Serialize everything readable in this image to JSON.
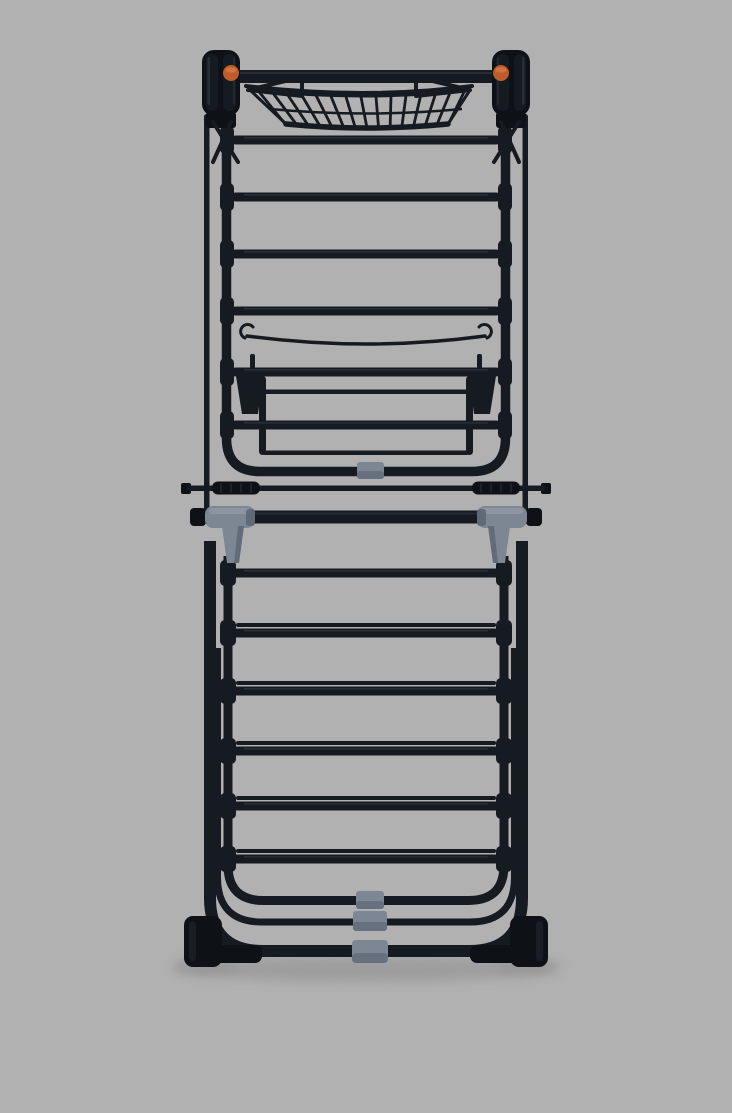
{
  "scene": {
    "type": "product-photo",
    "description": "Black foldable clothes airer drying rack shown folded flat, front view, standing on a plain gray studio background",
    "background": "#b1b1b1"
  },
  "colors": {
    "bg": "#b1b1b1",
    "frame": "#161a21",
    "frame_dark": "#0e1116",
    "highlight": "#3c434e",
    "clip": "#7d8693",
    "clip_dark": "#596270",
    "clip_light": "#9aa3af",
    "accent": "#bf5c2b",
    "accent_light": "#d97f4a",
    "shadow": "#8f8f8f"
  },
  "parts": {
    "top_bar": "top cross bar",
    "basket": "wire accessory basket hooked on the top bar",
    "hinges": "folding hinge housings, left and right",
    "orange_clips": "orange locking clips beside the hinges",
    "top_rungs": "four drying rungs in the upper section",
    "hanger_wire": "thin sagging accessory wire with end hooks",
    "folded_wing": "folded-in drying wing with rounded bottom frame",
    "wing_clip": "gray clip centered on the wing bottom bar",
    "tension_bar": "thin bar with ribbed black grips",
    "crossbar": "main pivot crossbar with gray plastic T-joints",
    "legs": "outer leg frame with rounded bottom corners",
    "lower_rungs": "six rung groups (one single, five pairs) in the lower section",
    "nested_frames": "two nested folded U-frames above the base",
    "bottom_clips": "three stacked gray clips at the bottom center",
    "feet": "black rubber feet at the bottom corners",
    "floor_shadow": "soft shadow on the floor under the rack"
  }
}
